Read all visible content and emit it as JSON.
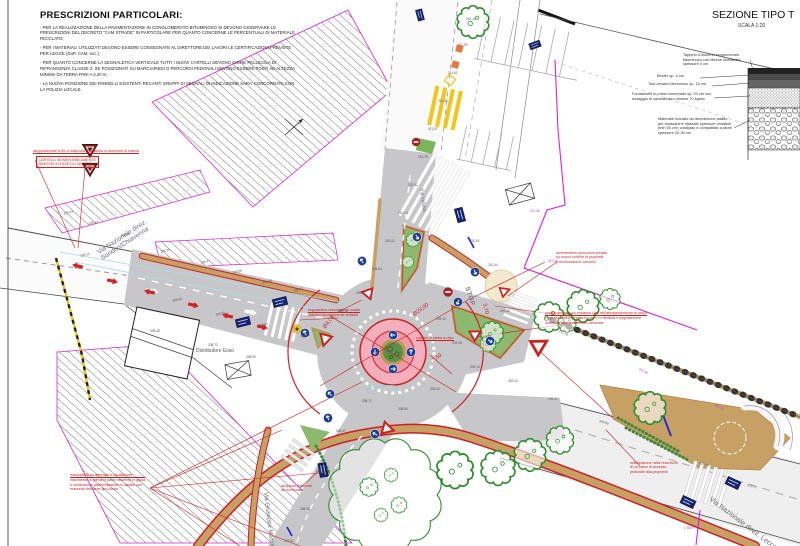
{
  "title_block": {
    "title": "PRESCRIZIONI PARTICOLARI:",
    "items": [
      "- PER LA REALIZZAZIONE DELLA PAVIMENTAZIONE IN CONGLOMERATO BITUMINOSO SI DEVONO OSSERVARE LE PRESCRIZIONI DEL DECRETO \"CAM STRADE\" IN PARTICOLARE PER QUANTO CONCERNE LE PERCENTUALI DI MATERIALE RICICLATO;",
      "- PER I MATERIALI UTILIZZATI DEVONO ESSERE CONSEGNATE AL DIRETTORE DEI LAVORI LE CERTIFICAZIONI PREVISTE PER LEGGE (DoP, CAM, ecc.);",
      "- PER QUANTO CONCERNE LA SEGNALETICA VERTICALE TUTTI I NUOVI CARTELLI DEVONO AVERE PELLICOLA DI RIFRANGENZA CLASSE 2; SE POSIZIONATI SU MARCIAPIEDI O PERCORSI PEDONALI DEVONO ESSERE POSTI AD ALTEZZA MINIMA DA TERRA PARI A 2,20 m;",
      "- LA NUOVA POSIZIONE DEI PANNELLI ESISTENTI RECANTI GRUPPI DI SEGNALI DI INDICAZIONE SARA' CONCORDATA CON LA POLIZIA LOCALE."
    ]
  },
  "section": {
    "title": "SEZIONE TIPO T",
    "scale": "SCALA 1:20",
    "layers": [
      "Tappeto d'usura in conglomerato bituminoso con bitume modificato spessore 4 cm",
      "Binder sp. 6 cm",
      "Tout-venant bituminoso sp. 10 cm",
      "Fondazione in misto cementato sp. 20 cm con dosaggio di calcestruzzo minimo 70 kg/mc",
      "Materiale riciclato da demolizione adatto per fondazione stradale spessore variabile (min 50 cm) costipato e compattato a strati spessore 20-30 cm"
    ]
  },
  "plan": {
    "streets": {
      "west_line1": "Via Nazionale direz.",
      "west_line2": "Sondrio/Chiavenna",
      "north": "Via Vallata",
      "south": "Via Giuseppe Mazzini",
      "east": "Via Nazionale direz. Lecco"
    },
    "poi": {
      "gas_station": "Distributore Esso"
    },
    "road_marking_stop": "STOP",
    "boundary_label": "L 50/7",
    "dimensions": [
      {
        "x": 322,
        "y": 326,
        "rot": -50,
        "text": "Ø4,00"
      },
      {
        "x": 412,
        "y": 313,
        "rot": -37,
        "text": "Ø23,00"
      },
      {
        "x": 431,
        "y": 359,
        "rot": -37,
        "text": "7,50"
      },
      {
        "x": 487,
        "y": 303,
        "rot": 77,
        "text": "3,70"
      }
    ],
    "annotations": [
      {
        "x": 33,
        "y": 149,
        "u": 1,
        "lines": [
          "da posizionare a 50 m dalla futura rotatoria in direzione di marcia"
        ]
      },
      {
        "x": 36,
        "y": 156,
        "box": 1,
        "lines": [
          "CARTELLI MOMENTANEAMENTE",
          "RIMOSSI IN FASE DI CANTIERE"
        ]
      },
      {
        "x": 308,
        "y": 308,
        "u": 1,
        "lines": [
          "segnaletica orizzontale in colato",
          "plastico bicomponente antiskid"
        ]
      },
      {
        "x": 416,
        "y": 336,
        "u": 1,
        "lines": [
          "cordolo in pietra a raso"
        ]
      },
      {
        "x": 545,
        "y": 311,
        "u": 1,
        "lines": [
          "posizionamento su entrambi i lati dell'attraversamento di nuovi",
          "corpi illuminanti su palo h max 6 m dedicati e segnalazione",
          "luminosa attraversamento pedonale"
        ]
      },
      {
        "x": 556,
        "y": 251,
        "lines": [
          "arretramento recinzione privata",
          "su nuovo confine di proprietà",
          "e ricollocazione cancello"
        ]
      },
      {
        "x": 70,
        "y": 473,
        "u": 1,
        "lines": [
          "marciapiedi da ampliare e riqualificare:",
          "rifacimento in pietra in parte esistente in guida",
          "e sostituzione pavimentazione in asfalto con",
          "massetto drenante tipo locale"
        ]
      },
      {
        "x": 630,
        "y": 461,
        "lines": [
          "realizzazione nella recinzione",
          "di un varco di accesso",
          "pedonale alla proprietà"
        ]
      },
      {
        "x": 281,
        "y": 484,
        "lines": [
          "lampione esistente",
          "da ricollocare"
        ]
      }
    ],
    "spot_elevations": [
      {
        "x": 63,
        "y": 212,
        "v": "208.03",
        "r": -14
      },
      {
        "x": 88,
        "y": 222,
        "v": "208.14",
        "r": -14
      },
      {
        "x": 120,
        "y": 234,
        "v": "208.26",
        "r": -14
      },
      {
        "x": 160,
        "y": 250,
        "v": "208.39",
        "r": -14
      },
      {
        "x": 200,
        "y": 261,
        "v": "208.47",
        "r": -14
      },
      {
        "x": 232,
        "y": 271,
        "v": "208.59",
        "r": -14
      },
      {
        "x": 262,
        "y": 281,
        "v": "208.68",
        "r": -14
      },
      {
        "x": 293,
        "y": 289,
        "v": "208.77",
        "r": -14
      },
      {
        "x": 80,
        "y": 254,
        "v": "208.11",
        "r": -14
      },
      {
        "x": 172,
        "y": 299,
        "v": "208.52",
        "r": -14
      },
      {
        "x": 215,
        "y": 313,
        "v": "208.66",
        "r": -14
      },
      {
        "x": 258,
        "y": 324,
        "v": "208.81",
        "r": -14
      },
      {
        "x": 300,
        "y": 335,
        "v": "209.02",
        "r": -14
      },
      {
        "x": 338,
        "y": 309,
        "v": "209.18",
        "r": 0
      },
      {
        "x": 356,
        "y": 291,
        "v": "209.31",
        "r": 0
      },
      {
        "x": 372,
        "y": 267,
        "v": "209.64",
        "r": 0
      },
      {
        "x": 385,
        "y": 239,
        "v": "210.02",
        "r": 0
      },
      {
        "x": 398,
        "y": 211,
        "v": "210.38",
        "r": 0
      },
      {
        "x": 408,
        "y": 183,
        "v": "210.52",
        "r": 0
      },
      {
        "x": 418,
        "y": 155,
        "v": "210.79",
        "r": 0
      },
      {
        "x": 428,
        "y": 127,
        "v": "211.07",
        "r": 0
      },
      {
        "x": 438,
        "y": 99,
        "v": "211.30",
        "r": 0
      },
      {
        "x": 448,
        "y": 71,
        "v": "211.62",
        "r": 0
      },
      {
        "x": 458,
        "y": 43,
        "v": "211.90",
        "r": 0
      },
      {
        "x": 466,
        "y": 17,
        "v": "212.14",
        "r": 0
      },
      {
        "x": 436,
        "y": 317,
        "v": "209.12",
        "r": 0
      },
      {
        "x": 452,
        "y": 341,
        "v": "209.06",
        "r": 0
      },
      {
        "x": 470,
        "y": 365,
        "v": "209.14",
        "r": 0
      },
      {
        "x": 430,
        "y": 387,
        "v": "208.92",
        "r": 0
      },
      {
        "x": 398,
        "y": 407,
        "v": "208.84",
        "r": 0
      },
      {
        "x": 362,
        "y": 399,
        "v": "208.71",
        "r": 0
      },
      {
        "x": 336,
        "y": 429,
        "v": "208.47",
        "r": 0
      },
      {
        "x": 316,
        "y": 469,
        "v": "208.22",
        "r": 0
      },
      {
        "x": 300,
        "y": 507,
        "v": "208.05",
        "r": 0
      },
      {
        "x": 284,
        "y": 539,
        "v": "207.91",
        "r": 0
      },
      {
        "x": 508,
        "y": 379,
        "v": "209.24",
        "r": 0
      },
      {
        "x": 548,
        "y": 397,
        "v": "209.47",
        "r": 0
      },
      {
        "x": 600,
        "y": 419,
        "v": "209.80",
        "r": 17
      },
      {
        "x": 650,
        "y": 439,
        "v": "210.12",
        "r": 17
      },
      {
        "x": 700,
        "y": 461,
        "v": "210.45",
        "r": 17
      },
      {
        "x": 748,
        "y": 483,
        "v": "210.77",
        "r": 17
      },
      {
        "x": 560,
        "y": 329,
        "v": "210.08",
        "r": 27,
        "c": "m"
      },
      {
        "x": 640,
        "y": 367,
        "v": "210.66",
        "r": 27,
        "c": "m"
      },
      {
        "x": 716,
        "y": 403,
        "v": "211.12",
        "r": 27,
        "c": "m"
      },
      {
        "x": 530,
        "y": 209,
        "v": "211.46",
        "r": 0,
        "c": "m"
      },
      {
        "x": 548,
        "y": 259,
        "v": "211.02",
        "r": 0,
        "c": "m"
      },
      {
        "x": 470,
        "y": 239,
        "v": "210.61",
        "r": 0
      },
      {
        "x": 488,
        "y": 263,
        "v": "210.44",
        "r": 0
      },
      {
        "x": 500,
        "y": 309,
        "v": "209.86",
        "r": 0
      },
      {
        "x": 246,
        "y": 355,
        "v": "208.90",
        "r": 0
      },
      {
        "x": 208,
        "y": 343,
        "v": "208.72",
        "r": 0
      },
      {
        "x": 150,
        "y": 329,
        "v": "208.45",
        "r": 0
      }
    ],
    "colors": {
      "new_asphalt": "#c7c7c9",
      "sidewalk_tan": "#c7a065",
      "island_pink": "#f6aebc",
      "curb_red": "#cc2222",
      "green_area": "#8db96f",
      "boundary_magenta": "#d622d6",
      "sign_blue": "#1d3c96",
      "marking_yellow": "#f2c51d"
    }
  }
}
